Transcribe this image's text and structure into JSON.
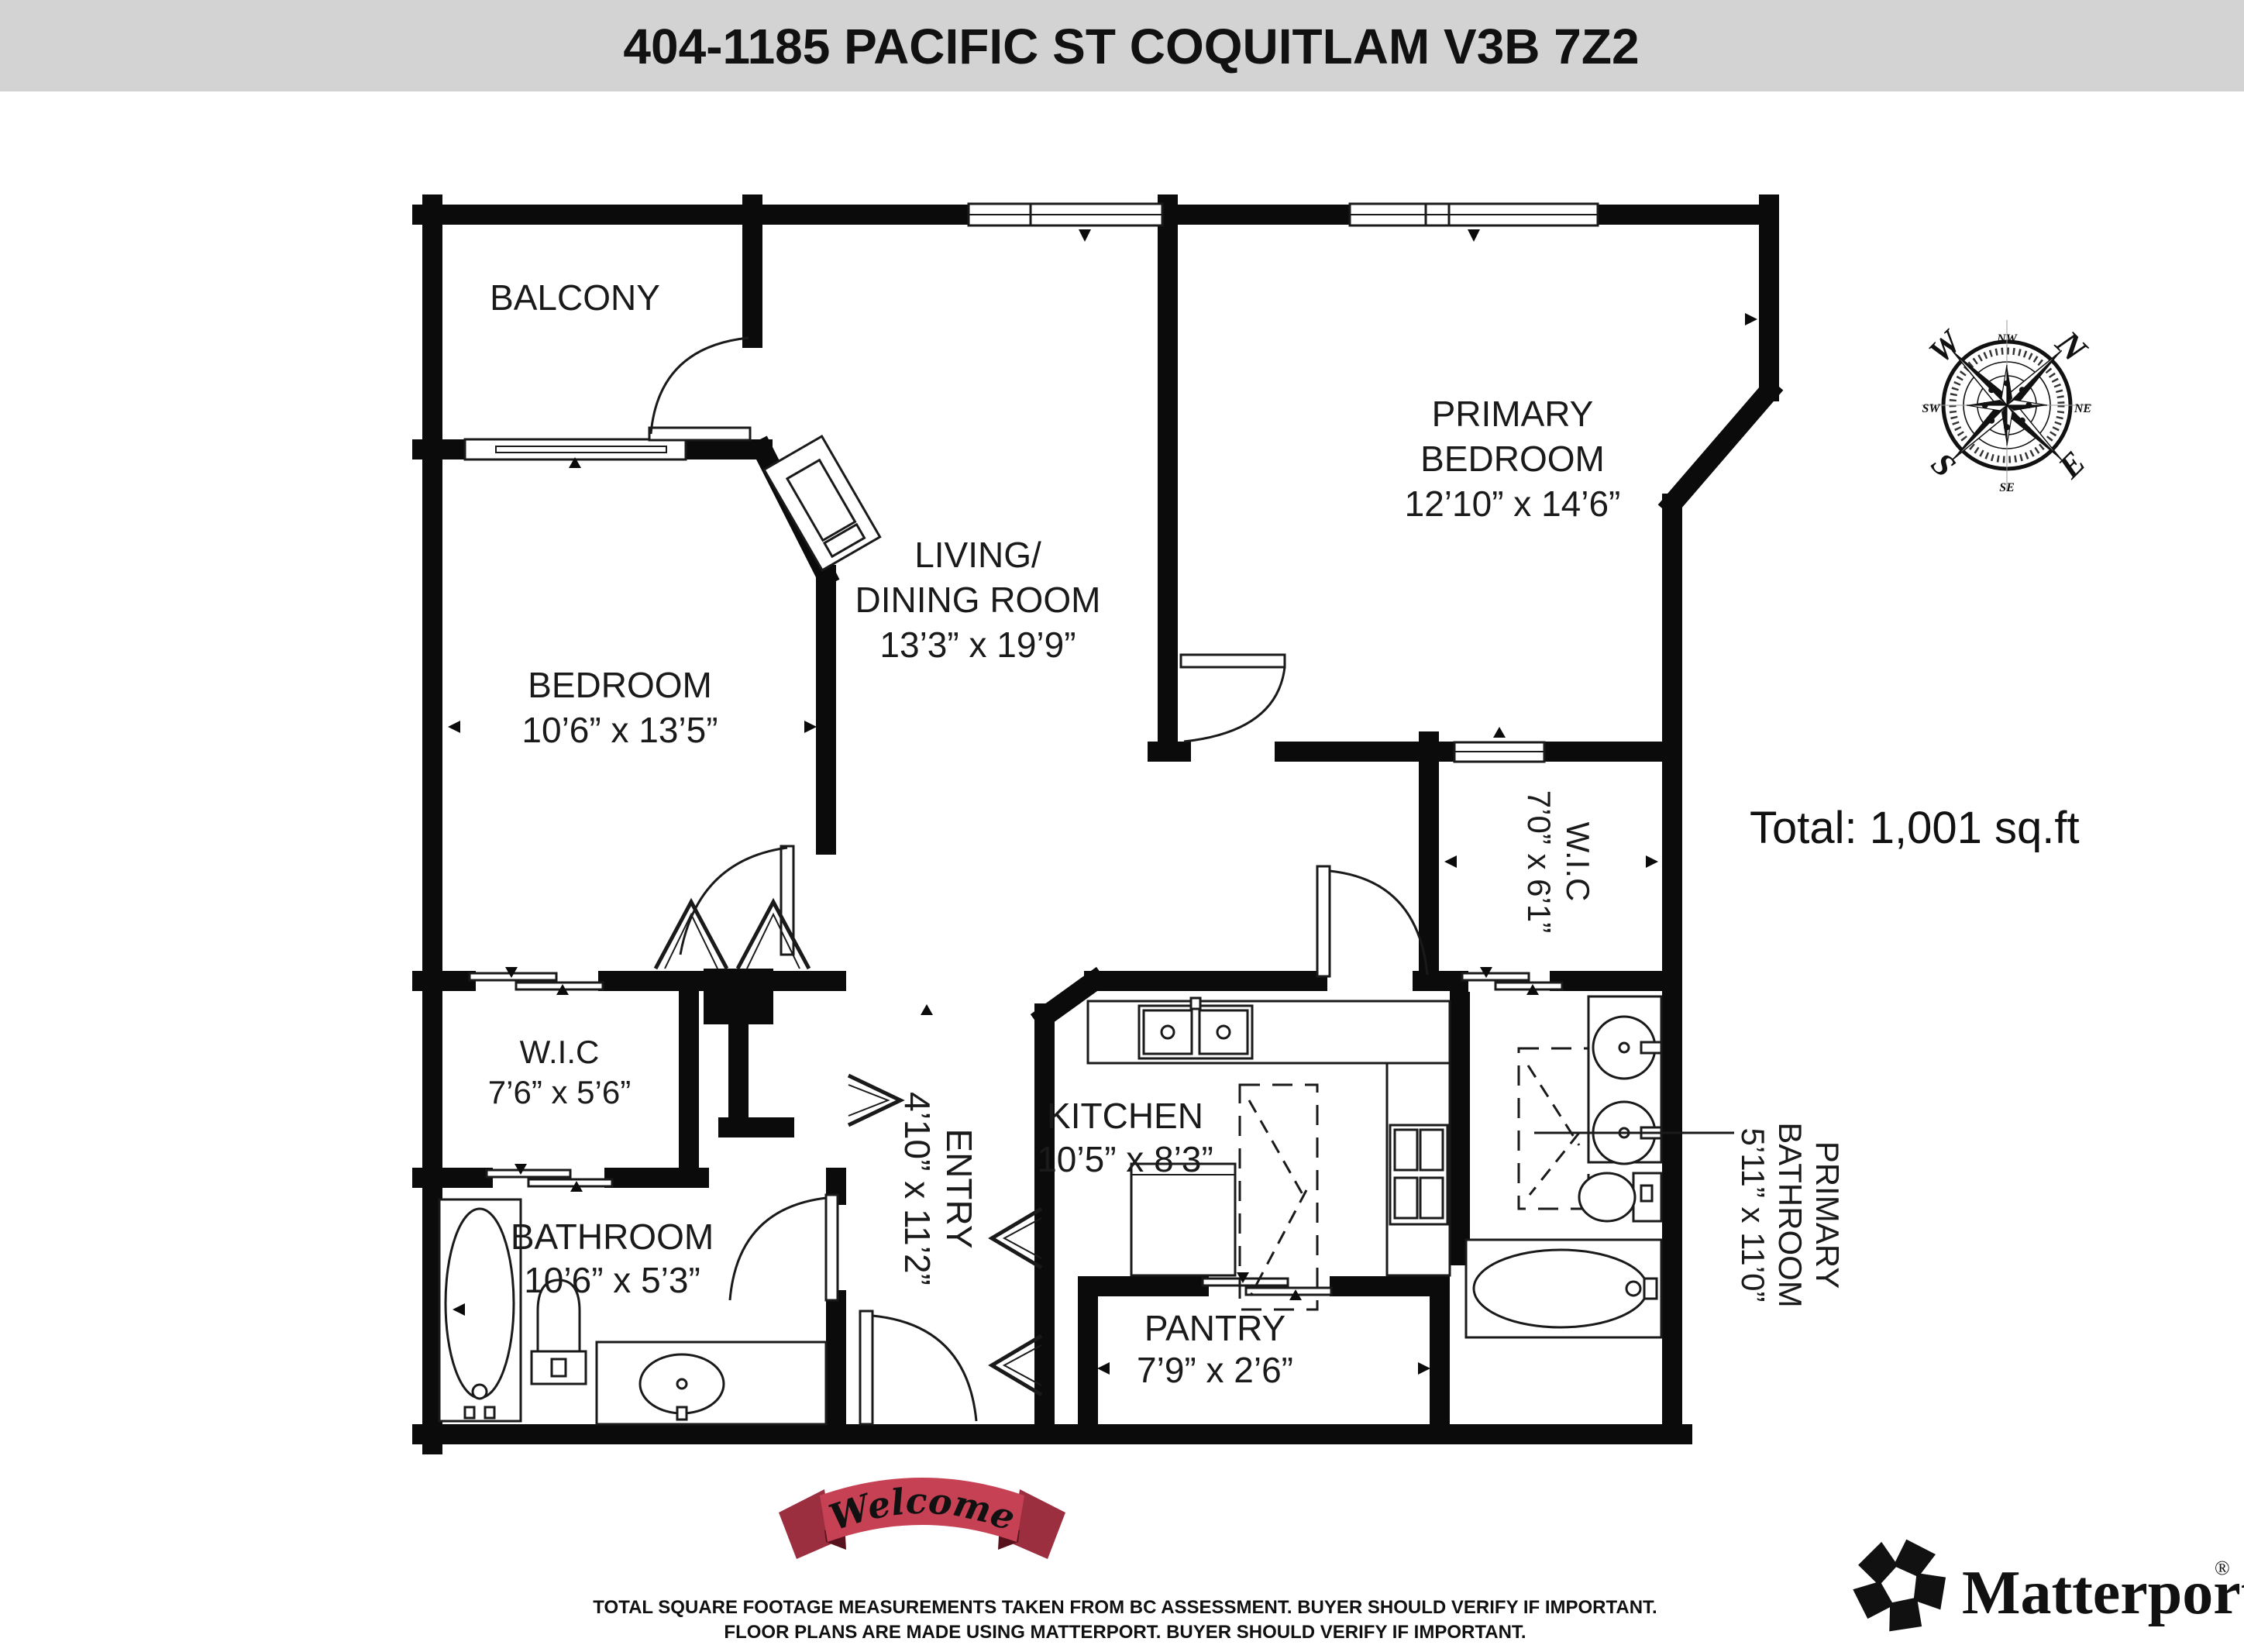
{
  "header": {
    "title": "404-1185 PACIFIC ST COQUITLAM V3B 7Z2"
  },
  "summary": {
    "total_area": "Total: 1,001 sq.ft"
  },
  "rooms": {
    "balcony": {
      "label": "BALCONY"
    },
    "living_dining": {
      "line1": "LIVING/",
      "line2": "DINING ROOM",
      "dims": "13’3” x 19’9”"
    },
    "primary_bedroom": {
      "line1": "PRIMARY",
      "line2": "BEDROOM",
      "dims": "12’10” x 14’6”"
    },
    "bedroom": {
      "label": "BEDROOM",
      "dims": "10’6” x 13’5”"
    },
    "wic_left": {
      "label": "W.I.C",
      "dims": "7’6” x 5’6”"
    },
    "bathroom": {
      "label": "BATHROOM",
      "dims": "10’6” x 5’3”"
    },
    "entry": {
      "label": "ENTRY",
      "dims": "4’10” x 11’2”"
    },
    "kitchen": {
      "label": "KITCHEN",
      "dims": "10’5” x 8’3”"
    },
    "pantry": {
      "label": "PANTRY",
      "dims": "7’9” x 2’6”"
    },
    "wic_primary": {
      "label": "W.I.C",
      "dims": "7’0” x 6’1”"
    },
    "primary_bathroom": {
      "line1": "PRIMARY",
      "line2": "BATHROOM",
      "dims": "5’11” x 11’0”"
    }
  },
  "compass": {
    "n": "N",
    "e": "E",
    "s": "S",
    "w": "W",
    "ne": "NE",
    "nw": "NW",
    "se": "SE",
    "sw": "SW"
  },
  "banner": {
    "text": "Welcome"
  },
  "branding": {
    "wordmark": "Matterport",
    "registered": "®"
  },
  "disclaimer": {
    "line1": "TOTAL SQUARE FOOTAGE MEASUREMENTS TAKEN FROM BC ASSESSMENT. BUYER SHOULD VERIFY IF IMPORTANT.",
    "line2": "FLOOR PLANS ARE MADE USING MATTERPORT. BUYER SHOULD VERIFY IF IMPORTANT."
  },
  "colors": {
    "header_bg": "#d3d3d3",
    "wall": "#0b0b0b",
    "banner_red": "#c64153",
    "banner_dark": "#9c2f3f",
    "compass_north": "#b03a2e"
  }
}
